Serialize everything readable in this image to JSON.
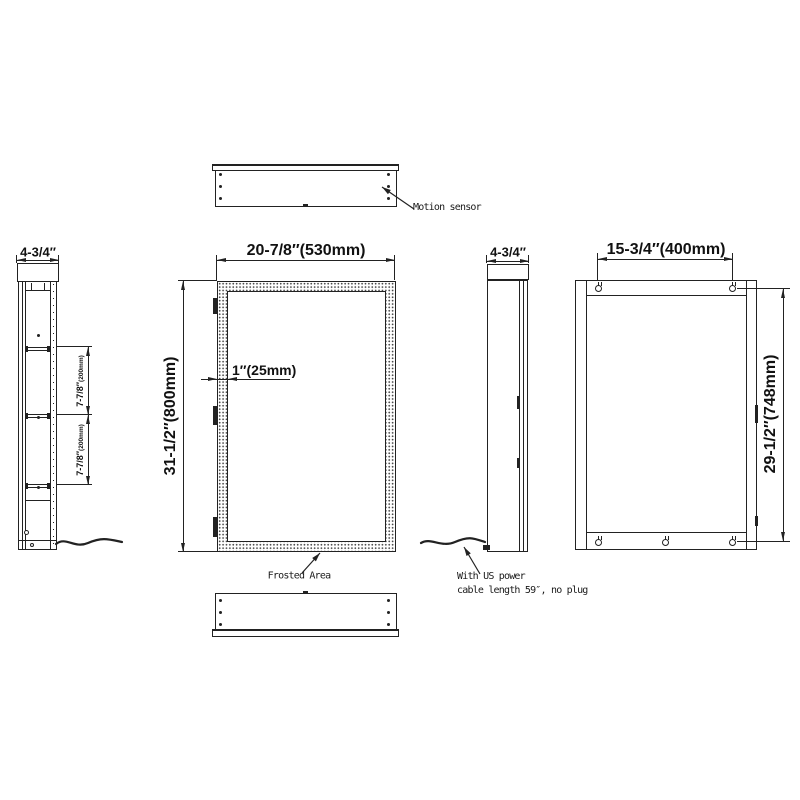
{
  "colors": {
    "line": "#222222",
    "background": "#ffffff"
  },
  "views": {
    "top_view": {
      "motion_sensor_label": "Motion sensor"
    },
    "left_section_view": {
      "depth_dim": "4-3/4″",
      "shelf_spacing_upper": {
        "inch": "7-7/8″",
        "mm": "(200mm)"
      },
      "shelf_spacing_lower": {
        "inch": "7-7/8″",
        "mm": "(200mm)"
      }
    },
    "front_view": {
      "width_dim": "20-7/8″(530mm)",
      "height_dim": "31-1/2″(800mm)",
      "frost_band_width_dim": "1″(25mm)",
      "frosted_area_label": "Frosted Area"
    },
    "side_view": {
      "depth_dim": "4-3/4″",
      "power_note_line1": "With US power",
      "power_note_line2": "cable length 59″, no plug"
    },
    "back_view": {
      "hanger_spacing_dim": "15-3/4″(400mm)",
      "hanger_height_dim": "29-1/2″(748mm)"
    }
  }
}
